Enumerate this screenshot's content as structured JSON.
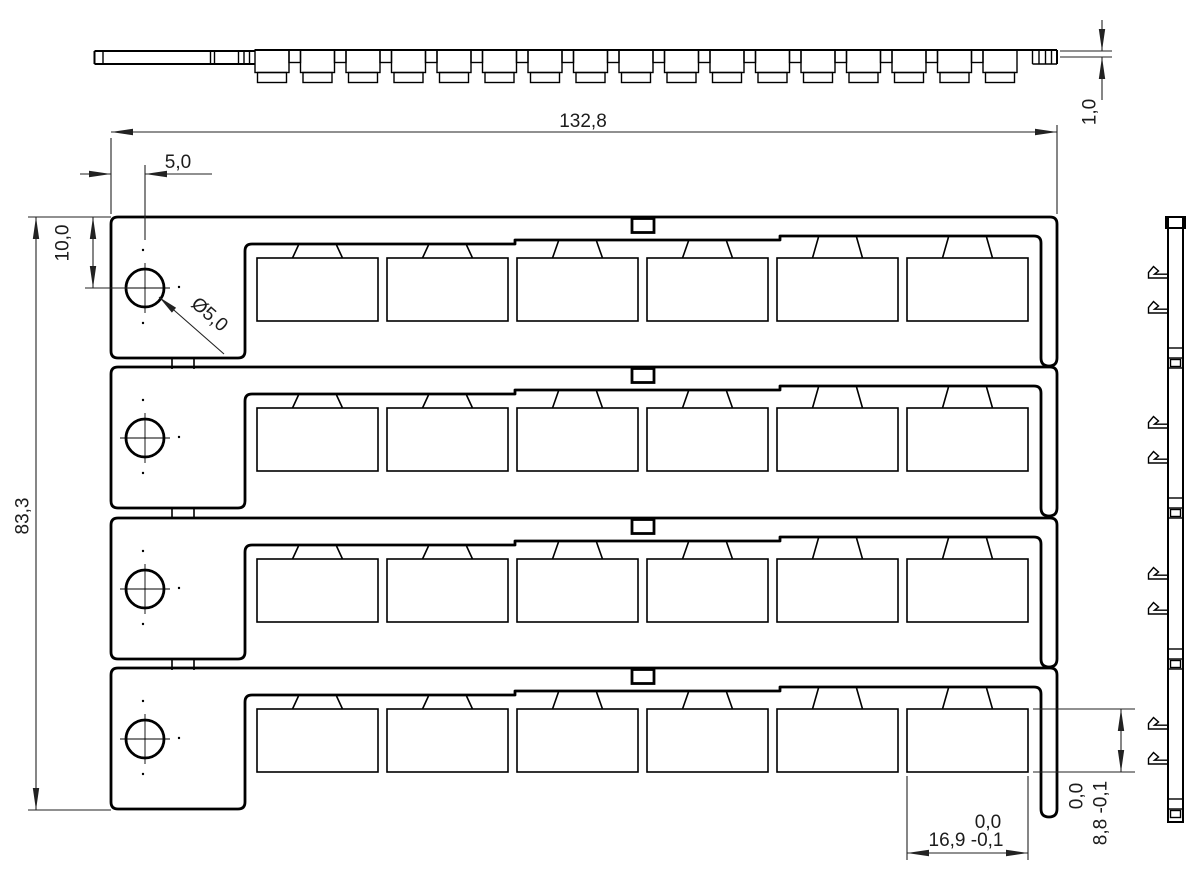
{
  "drawing": {
    "type": "marker-strip-card",
    "rows": 4,
    "markers_per_row": 6,
    "line_color": "#000000",
    "dim_color": "#222222",
    "background": "#ffffff"
  },
  "dimensions": {
    "total_width": "132,8",
    "thickness": "1,0",
    "hole_offset_x": "5,0",
    "hole_offset_y": "10,0",
    "total_height": "83,3",
    "hole_diameter": "Ø5,0",
    "marker_width": "16,9 -0,1",
    "marker_width_upper_tol": "0,0",
    "marker_height": "8,8 -0,1",
    "marker_height_upper_tol": "0,0"
  }
}
